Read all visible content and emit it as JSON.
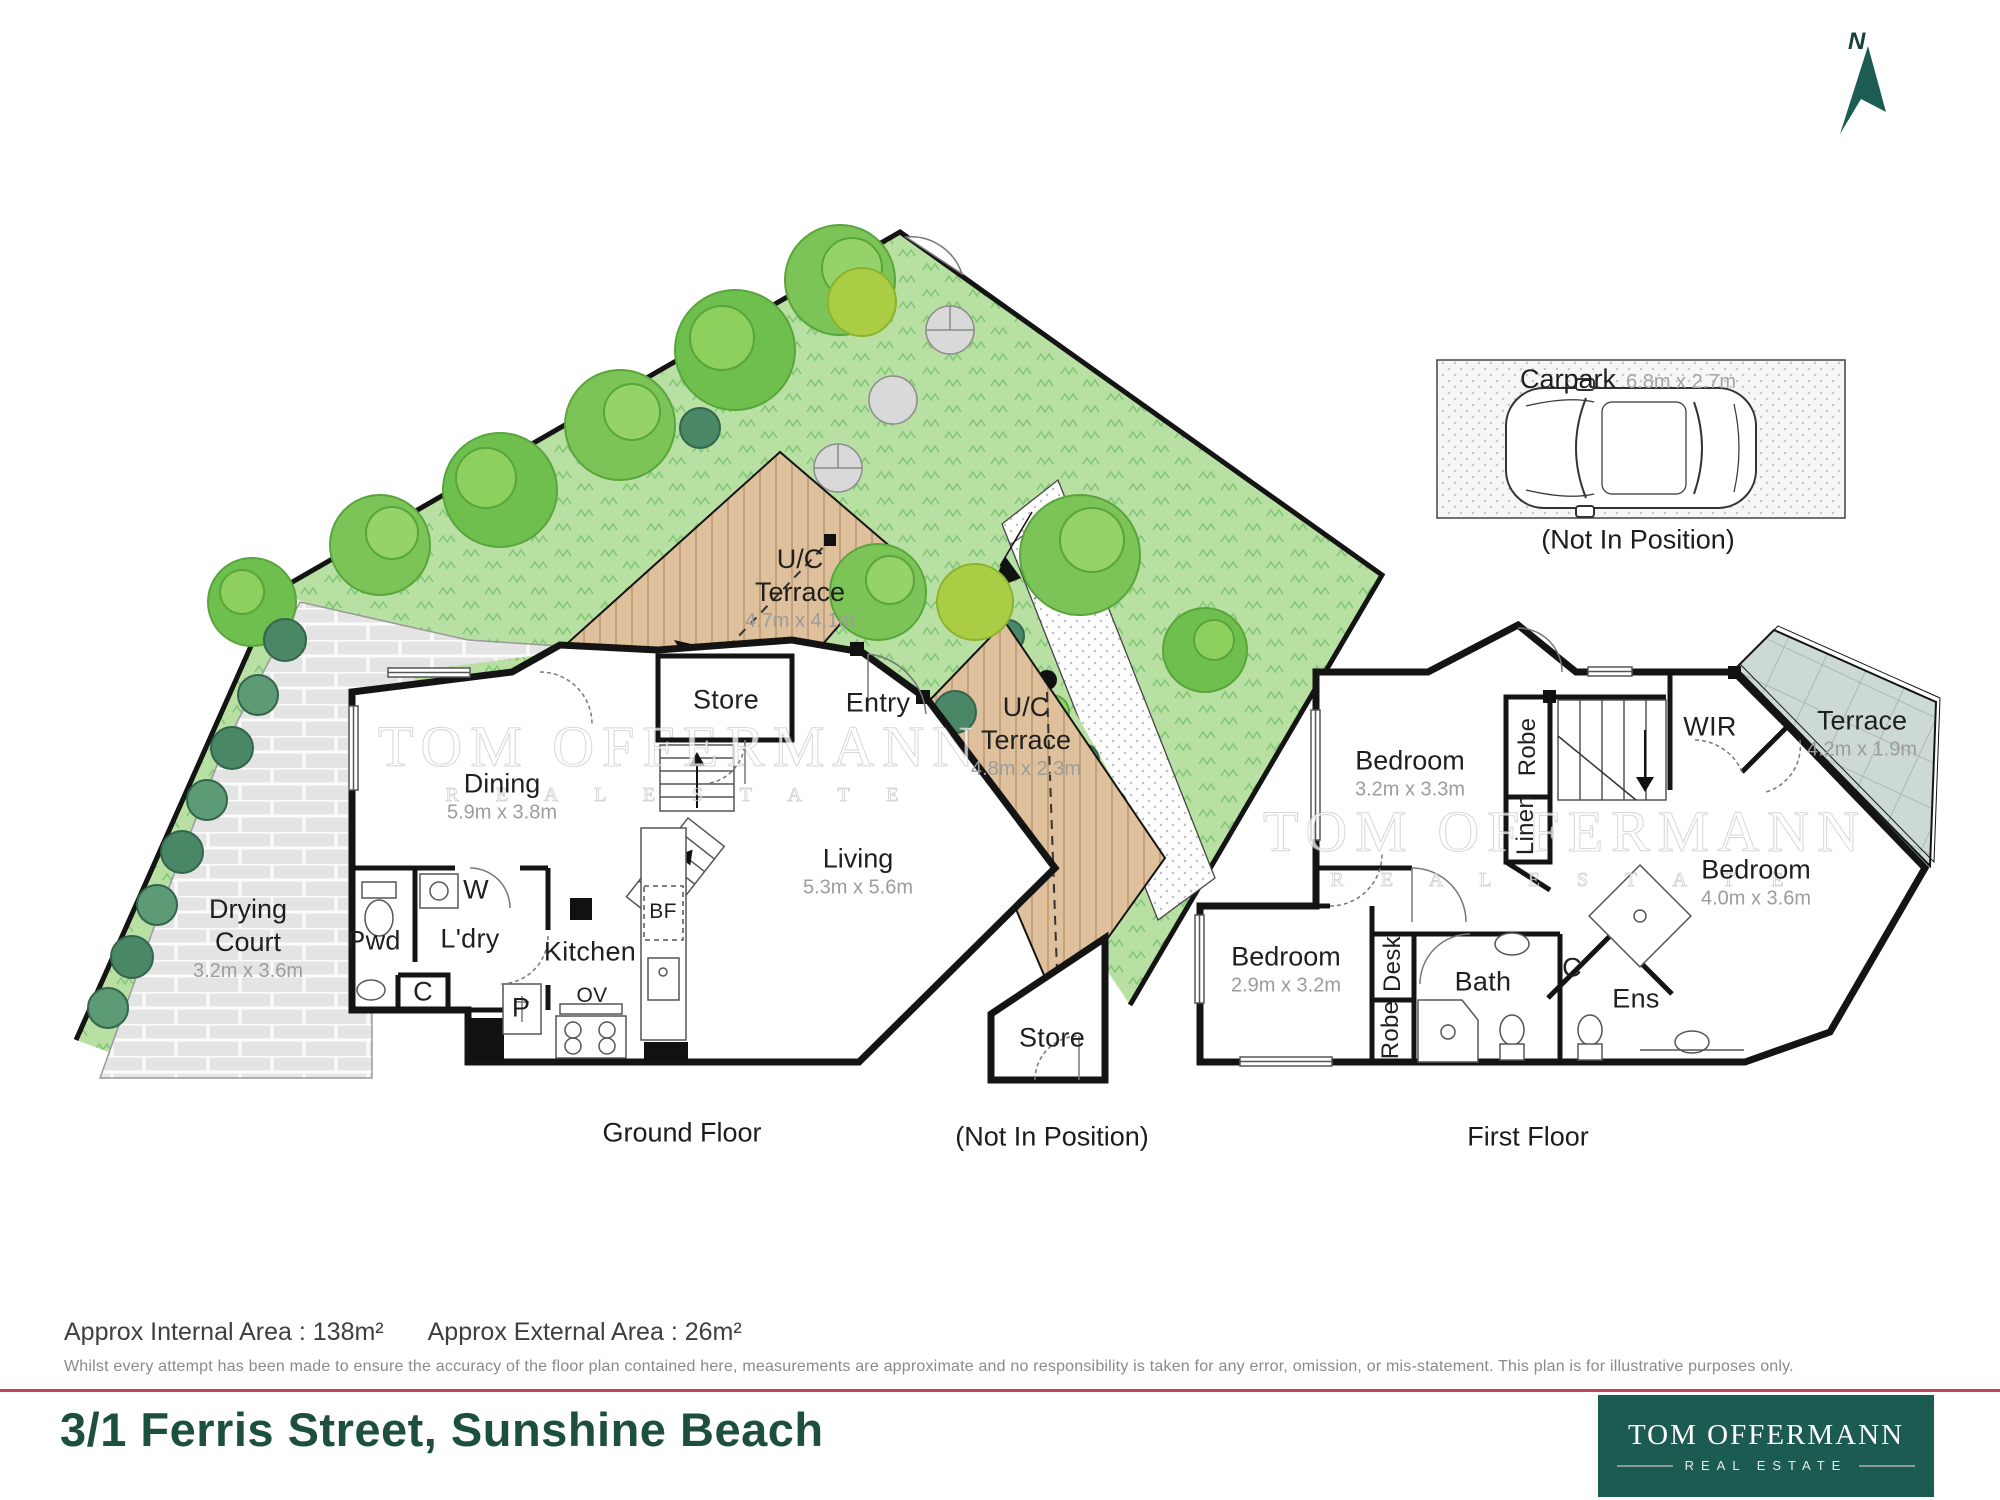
{
  "north_indicator": {
    "label": "N"
  },
  "carpark": {
    "name": "Carpark",
    "dims": "6.8m x 2.7m",
    "note": "(Not In Position)"
  },
  "watermark": {
    "line1": "TOM OFFERMANN",
    "line2": "R E A L   E S T A T E"
  },
  "ground_floor": {
    "caption": "Ground Floor",
    "rooms": {
      "uc_terrace_1": {
        "name_line1": "U/C",
        "name_line2": "Terrace",
        "dims": "4.7m x 4.1m"
      },
      "uc_terrace_2": {
        "name_line1": "U/C",
        "name_line2": "Terrace",
        "dims": "4.8m x 2.3m"
      },
      "store": {
        "name": "Store"
      },
      "entry": {
        "name": "Entry"
      },
      "dining": {
        "name": "Dining",
        "dims": "5.9m x 3.8m"
      },
      "drying_court": {
        "name_line1": "Drying",
        "name_line2": "Court",
        "dims": "3.2m x 3.6m"
      },
      "pwd": {
        "name": "Pwd"
      },
      "washer": {
        "name": "W"
      },
      "laundry": {
        "name": "L'dry"
      },
      "closet": {
        "name": "C"
      },
      "kitchen": {
        "name": "Kitchen"
      },
      "pantry": {
        "name": "P"
      },
      "oven": {
        "name": "OV"
      },
      "bar_fridge": {
        "name": "BF"
      },
      "living": {
        "name": "Living",
        "dims": "5.3m x 5.6m"
      },
      "store_external": {
        "name": "Store",
        "note": "(Not In Position)"
      }
    }
  },
  "first_floor": {
    "caption": "First Floor",
    "rooms": {
      "bedroom_1": {
        "name": "Bedroom",
        "dims": "3.2m x 3.3m"
      },
      "robe_1": {
        "name": "Robe"
      },
      "linen": {
        "name": "Linen"
      },
      "wir": {
        "name": "WIR"
      },
      "terrace": {
        "name": "Terrace",
        "dims": "4.2m x 1.9m"
      },
      "bedroom_2": {
        "name": "Bedroom",
        "dims": "4.0m x 3.6m"
      },
      "bedroom_3": {
        "name": "Bedroom",
        "dims": "2.9m x 3.2m"
      },
      "desk": {
        "name": "Desk"
      },
      "robe_2": {
        "name": "Robe"
      },
      "bath": {
        "name": "Bath"
      },
      "closet": {
        "name": "C"
      },
      "ensuite": {
        "name": "Ens"
      }
    }
  },
  "footer": {
    "internal_area": "Approx Internal Area : 138m²",
    "external_area": "Approx External Area : 26m²",
    "disclaimer": "Whilst every attempt has been made to ensure the accuracy of the floor plan contained here, measurements are approximate and no responsibility is taken for any error, omission, or mis-statement. This plan is for illustrative purposes only.",
    "address": "3/1 Ferris Street, Sunshine Beach",
    "brand": {
      "line1": "TOM OFFERMANN",
      "line2": "REAL ESTATE"
    }
  },
  "colors": {
    "brand_green": "#1c5b51",
    "title_green": "#1d4f3f",
    "divider_red": "#c04659",
    "grass": "#b9e0a3",
    "deck": "#dfc09c",
    "terrace_tile": "#cdd9d4",
    "wall": "#141414"
  }
}
